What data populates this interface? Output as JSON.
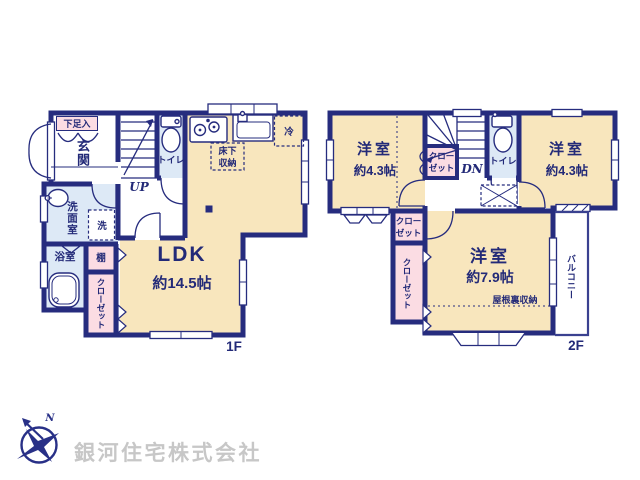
{
  "floor1": {
    "label": "1F",
    "entry_label": "玄関",
    "shoe_cabinet_label": "下足入",
    "toilet_label": "トイレ",
    "stairs_label": "UP",
    "ldk_label": "LDK",
    "ldk_size": "約14.5帖",
    "underfloor_line1": "床下",
    "underfloor_line2": "収納",
    "fridge_label": "冷",
    "washroom_label": "洗面室",
    "washer_label": "洗",
    "bath_label": "浴室",
    "shelf_label": "棚",
    "closet_label": "クローゼット"
  },
  "floor2": {
    "label": "2F",
    "bedroom_west_label": "洋室",
    "bedroom_west_size": "約4.3帖",
    "bedroom_east_label": "洋室",
    "bedroom_east_size": "約4.3帖",
    "bedroom_main_label": "洋室",
    "bedroom_main_size": "約7.9帖",
    "attic_storage_label": "屋根裏収納",
    "stairs_label": "DN",
    "toilet_label": "トイレ",
    "closet_west_line1": "クロー",
    "closet_west_line2": "ゼット",
    "closet_small_line1": "クロー",
    "closet_small_line2": "ゼット",
    "closet_tall_label": "クローゼット",
    "balcony_label": "バルコニー"
  },
  "footer": {
    "company_name": "銀河住宅株式会社",
    "north_label": "N"
  },
  "colors": {
    "wall_navy": "#262c7e",
    "room_cream": "#f8e6bd",
    "wet_blue": "#dde9f6",
    "closet_pink": "#fbdce3",
    "company_gray": "#c7c7c7"
  }
}
